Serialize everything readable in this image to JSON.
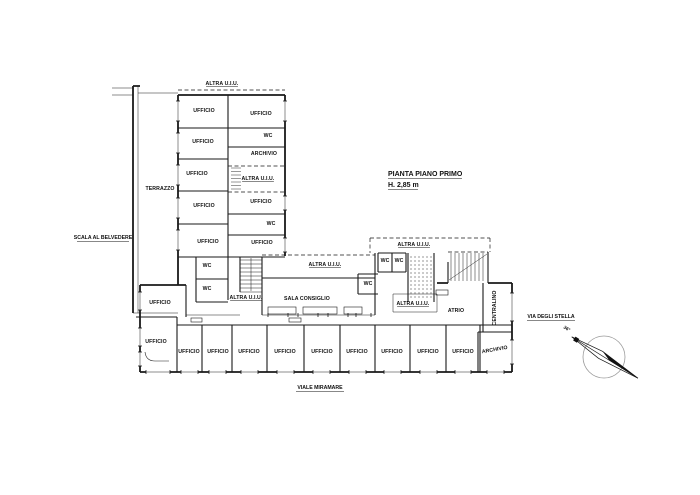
{
  "drawing": {
    "title": {
      "line1": "PIANTA PIANO PRIMO",
      "line2": "H. 2,85 m"
    },
    "annotations": {
      "left_street": "SCALA AL BELVEDERE",
      "right_street": "VIA DEGLI STELLA",
      "bottom_street": "VIALE MIRAMARE",
      "compass_bearing": "36°"
    },
    "label_texts": {
      "ufficio": "UFFICIO",
      "wc": "WC",
      "archivio": "ARCHIVIO",
      "terrazzo": "TERRAZZO",
      "altra_uiu": "ALTRA U.I.U.",
      "sala_consiglio": "SALA CONSIGLIO",
      "atrio": "ATRIO",
      "centralino": "CENTRALINO"
    },
    "room_labels": [
      {
        "t": "altra_uiu",
        "x": 222,
        "y": 85,
        "u": 1
      },
      {
        "t": "terrazzo",
        "x": 160,
        "y": 190
      },
      {
        "t": "ufficio",
        "x": 204,
        "y": 112
      },
      {
        "t": "ufficio",
        "x": 203,
        "y": 143
      },
      {
        "t": "ufficio",
        "x": 197,
        "y": 175
      },
      {
        "t": "ufficio",
        "x": 204,
        "y": 207
      },
      {
        "t": "ufficio",
        "x": 208,
        "y": 243
      },
      {
        "t": "wc",
        "x": 207,
        "y": 267
      },
      {
        "t": "wc",
        "x": 207,
        "y": 290
      },
      {
        "t": "ufficio",
        "x": 261,
        "y": 115
      },
      {
        "t": "wc",
        "x": 268,
        "y": 137
      },
      {
        "t": "archivio",
        "x": 264,
        "y": 155
      },
      {
        "t": "altra_uiu",
        "x": 258,
        "y": 180,
        "u": 1
      },
      {
        "t": "ufficio",
        "x": 261,
        "y": 203
      },
      {
        "t": "wc",
        "x": 271,
        "y": 225
      },
      {
        "t": "ufficio",
        "x": 262,
        "y": 244
      },
      {
        "t": "altra_uiu",
        "x": 246,
        "y": 299,
        "u": 1
      },
      {
        "t": "sala_consiglio",
        "x": 307,
        "y": 300
      },
      {
        "t": "altra_uiu",
        "x": 325,
        "y": 266,
        "u": 1
      },
      {
        "t": "wc",
        "x": 368,
        "y": 285
      },
      {
        "t": "wc",
        "x": 385,
        "y": 262
      },
      {
        "t": "wc",
        "x": 399,
        "y": 262
      },
      {
        "t": "altra_uiu",
        "x": 414,
        "y": 246,
        "u": 1
      },
      {
        "t": "altra_uiu",
        "x": 413,
        "y": 305,
        "u": 1
      },
      {
        "t": "atrio",
        "x": 456,
        "y": 312
      },
      {
        "t": "centralino",
        "x": 496,
        "y": 308,
        "rot": -90
      },
      {
        "t": "ufficio",
        "x": 160,
        "y": 304
      },
      {
        "t": "ufficio",
        "x": 156,
        "y": 343
      },
      {
        "t": "ufficio",
        "x": 189,
        "y": 353
      },
      {
        "t": "ufficio",
        "x": 218,
        "y": 353
      },
      {
        "t": "ufficio",
        "x": 249,
        "y": 353
      },
      {
        "t": "ufficio",
        "x": 285,
        "y": 353
      },
      {
        "t": "ufficio",
        "x": 322,
        "y": 353
      },
      {
        "t": "ufficio",
        "x": 357,
        "y": 353
      },
      {
        "t": "ufficio",
        "x": 392,
        "y": 353
      },
      {
        "t": "ufficio",
        "x": 428,
        "y": 353
      },
      {
        "t": "ufficio",
        "x": 463,
        "y": 353
      },
      {
        "t": "archivio",
        "x": 495,
        "y": 351,
        "rot": -10
      }
    ],
    "ink_color": "#1a1a1a",
    "compass_circle_color": "#9a9a9a"
  }
}
